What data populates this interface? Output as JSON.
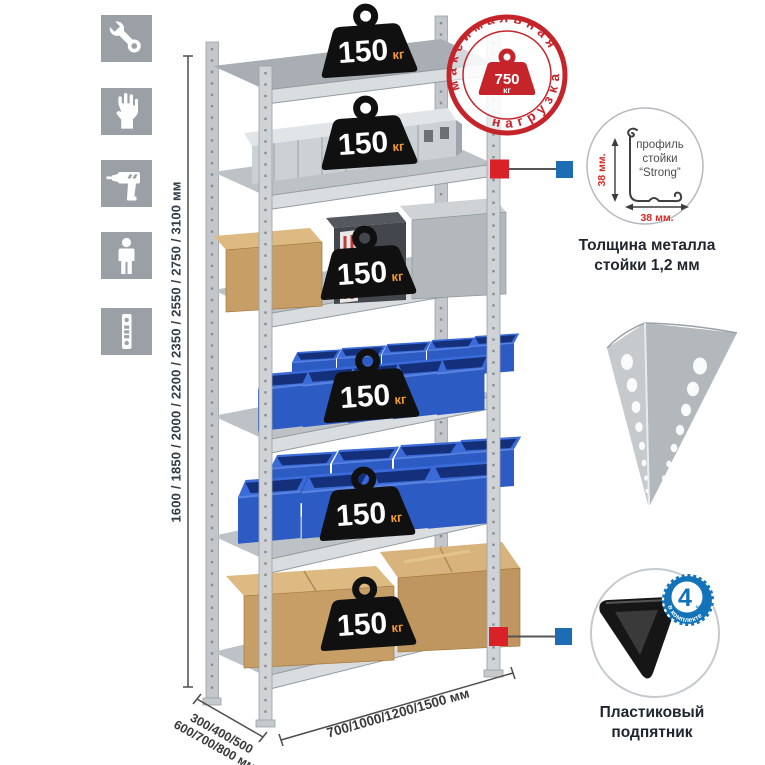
{
  "sidebar": {
    "icons": [
      {
        "name": "wrench"
      },
      {
        "name": "gloves"
      },
      {
        "name": "drill"
      },
      {
        "name": "person"
      },
      {
        "name": "post-profile"
      }
    ]
  },
  "dimensions": {
    "height": "1600 / 1850 / 2000 / 2200 / 2350 / 2550 / 2750 / 3100 мм",
    "depth_line1": "300/400/500",
    "depth_line2": "600/700/800 мм",
    "width": "700/1000/1200/1500 мм"
  },
  "rack": {
    "shelf_count": 6,
    "load_value": "150",
    "load_unit": "кг"
  },
  "stamp": {
    "arc_top": "максимальная",
    "arc_bottom": "нагрузка",
    "value": "750",
    "unit": "кг",
    "color": "#c5242b"
  },
  "profile_detail": {
    "line1": "профиль",
    "line2": "стойки",
    "line3": "“Strong”",
    "dim_vertical": "38 мм.",
    "dim_horizontal": "38 мм.",
    "caption_line1": "Толщина металла",
    "caption_line2": "стойки 1,2 мм"
  },
  "foot_detail": {
    "badge_value": "4",
    "badge_small": "штуки",
    "badge_arc": "в комплекте",
    "badge_color": "#1273b8",
    "caption_line1": "Пластиковый",
    "caption_line2": "подпятник"
  },
  "colors": {
    "connector_red": "#da2128",
    "connector_blue": "#1e6db4",
    "bin_blue": "#2d5bc4",
    "cardboard": "#c79e66",
    "weight_black": "#101011",
    "weight_unit_orange": "#f29a2e",
    "icon_tile_gray": "#9aa0a5"
  }
}
